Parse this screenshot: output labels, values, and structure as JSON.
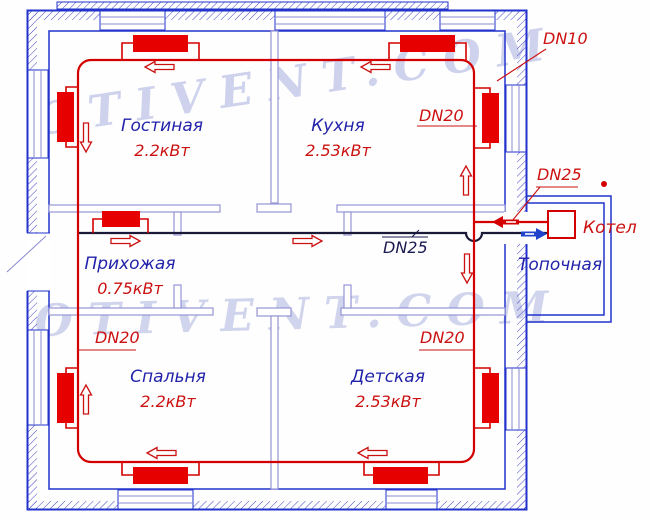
{
  "title": "Схема однотрубного отопления (план дома)",
  "watermark": {
    "top": "OTIVENT.COM",
    "middle": "OTIVENT.COM"
  },
  "rooms": [
    {
      "id": "gostinaya",
      "name": "Гостиная",
      "power": "2.2кВт"
    },
    {
      "id": "kuhnya",
      "name": "Кухня",
      "power": "2.53кВт"
    },
    {
      "id": "prihozhaya",
      "name": "Прихожая",
      "power": "0.75кВт"
    },
    {
      "id": "spalnya",
      "name": "Спальня",
      "power": "2.2кВт"
    },
    {
      "id": "detskaya",
      "name": "Детская",
      "power": "2.53кВт"
    }
  ],
  "boiler_room": {
    "name": "Топочная"
  },
  "equipment": {
    "boiler_label": "Котел"
  },
  "pipe_labels": {
    "dn10": "DN10",
    "dn20_kitchen": "DN20",
    "dn20_hall": "DN20",
    "dn20_nursery": "DN20",
    "dn25_boiler": "DN25",
    "dn25_return": "DN25"
  },
  "colors": {
    "supply_pipe": "#d40000",
    "radiator": "#e60000",
    "return_pipe": "#1a1a38",
    "outer_wall": "#2233cc",
    "interior_wall": "#9595d6",
    "room_text": "#2222aa",
    "power_text": "#cc1111",
    "watermark": "#ced2ec"
  }
}
